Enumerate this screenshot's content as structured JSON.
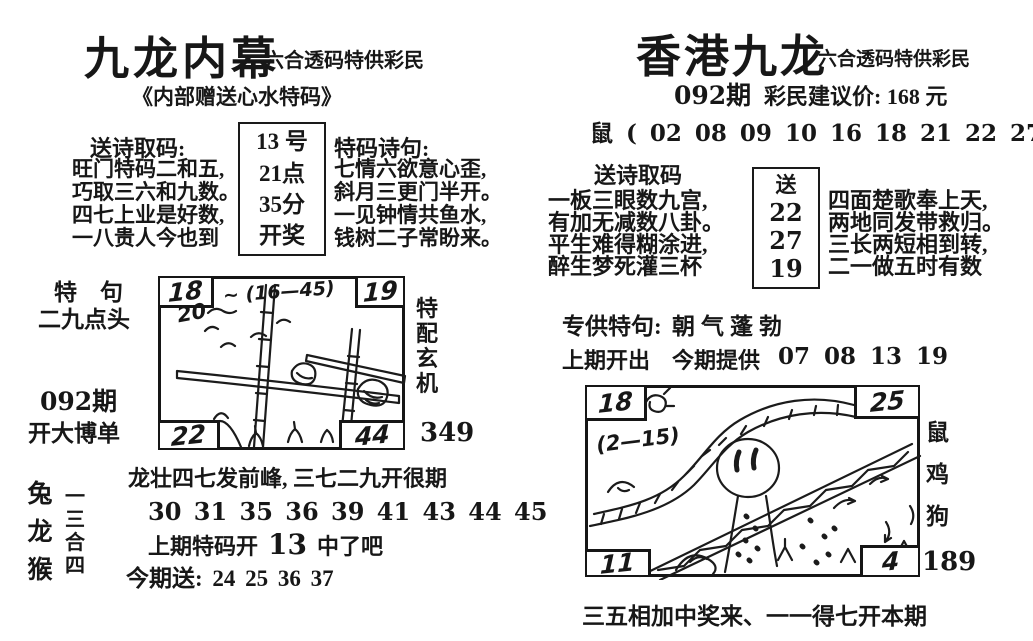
{
  "left_page": {
    "title": "九龙内幕",
    "subtitle": "六合透码特供彩民",
    "tagline": "《内部赠送心水特码》",
    "poems": {
      "left_heading": "送诗取码:",
      "left_lines": [
        "旺门特码二和五,",
        "巧取三六和九数。",
        "四七上业是好数,",
        "一八贵人今也到"
      ],
      "box_lines": [
        "13 号",
        "21点",
        "35分",
        "开奖"
      ],
      "right_heading": "特码诗句:",
      "right_lines": [
        "七情六欲意心歪,",
        "斜月三更门半开。",
        "一见钟情共鱼水,",
        "钱树二子常盼来。"
      ]
    },
    "sketch": {
      "label_line1": "特　句",
      "label_line2": "二九点头",
      "issue": "092期",
      "issue_note": "开大博单",
      "corners": {
        "tl": "18",
        "tr": "19",
        "bl": "22",
        "br": "44"
      },
      "note_top": "~ (16—45)",
      "note_num": "20",
      "side_label": "特配玄机",
      "side_number": "349"
    },
    "bottom": {
      "zodiac_vertical": "兔龙猴",
      "combo_vertical": "一三合四",
      "line1": "龙壮四七发前峰, 三七二九开很期",
      "numbers": "30 31 35 36 39 41 43 44 45",
      "prev_prefix": "上期特码开",
      "prev_number": "13",
      "prev_suffix": "中了吧",
      "gift_line": "今期送: 24 25 36 37"
    }
  },
  "right_page": {
    "title": "香港九龙",
    "subtitle": "六合透码特供彩民",
    "issue": "092期",
    "price": "彩民建议价: 168 元",
    "zodiac_row": "鼠 ( 02 08 09 10 16 18 21 22 27    ) 鸡",
    "poems": {
      "heading": "送诗取码",
      "left_lines": [
        "一板三眼数九宫,",
        "有加无减数八卦。",
        "平生难得糊涂进,",
        "醉生梦死灌三杯"
      ],
      "box_label": "送",
      "box_numbers": [
        "22",
        "27",
        "19"
      ],
      "right_lines": [
        "四面楚歌奉上天,",
        "两地同发带救归。",
        "三长两短相到转,",
        "二一做五时有数"
      ]
    },
    "special": {
      "label": "专供特句:",
      "value": "朝气蓬勃",
      "prev_label": "上期开出",
      "now_label": "今期提供",
      "now_numbers": "07 08 13 19"
    },
    "sketch": {
      "corners": {
        "tl": "18",
        "tr": "25",
        "bl": "11",
        "br": "4"
      },
      "note": "(2—15)",
      "side_zodiac": "鼠鸡狗",
      "side_number": "189"
    },
    "caption": "三五相加中奖来、一一得七开本期"
  }
}
